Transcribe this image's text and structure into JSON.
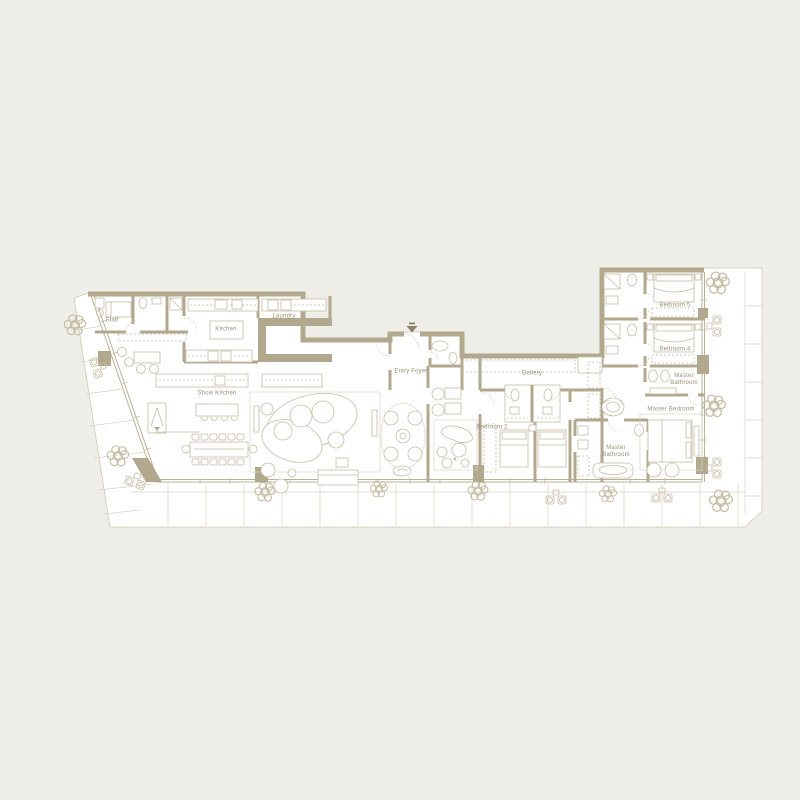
{
  "plan": {
    "rooms": [
      {
        "label": "Staff"
      },
      {
        "label": "Kitchen"
      },
      {
        "label": "Laundry"
      },
      {
        "label": "Show Kitchen"
      },
      {
        "label": "Entry Foyer"
      },
      {
        "label": "Gallery"
      },
      {
        "label": "Bedroom 2"
      },
      {
        "label": "Bedroom 5"
      },
      {
        "label": "Bedroom 4"
      },
      {
        "label": "Master Bathroom"
      },
      {
        "label": "Master Bedroom"
      },
      {
        "label": "Master Bathroom"
      }
    ],
    "entry_marker": {
      "icon": "down-arrow"
    }
  },
  "colors": {
    "background": "#efede7",
    "floor": "#ffffff",
    "wall": "#b1a88e",
    "furniture_line": "#c6bda5",
    "label_text": "#998f77",
    "tile_line": "#d9d2c0"
  }
}
